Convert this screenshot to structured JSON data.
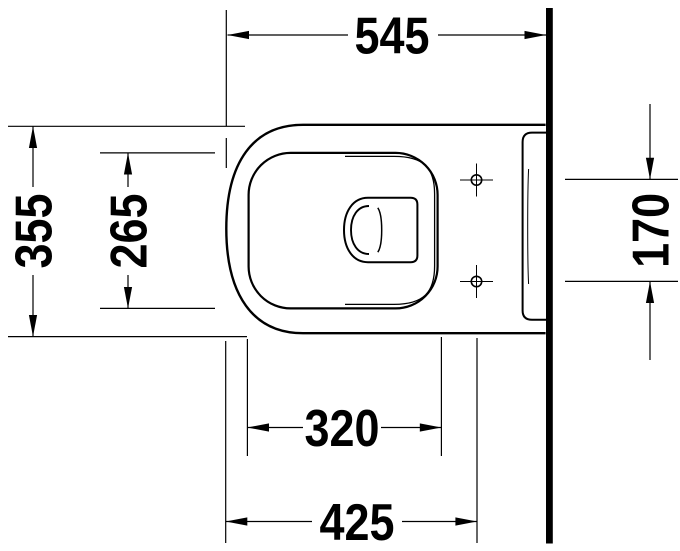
{
  "dims": {
    "depth_total": {
      "value": "545"
    },
    "width_total": {
      "value": "355"
    },
    "bowl_inner_width": {
      "value": "265"
    },
    "hole_spacing": {
      "value": "170"
    },
    "bowl_inner_depth": {
      "value": "320"
    },
    "hole_depth": {
      "value": "425"
    }
  },
  "colors": {
    "line": "#000000",
    "wall": "#000000",
    "background": "#ffffff"
  }
}
